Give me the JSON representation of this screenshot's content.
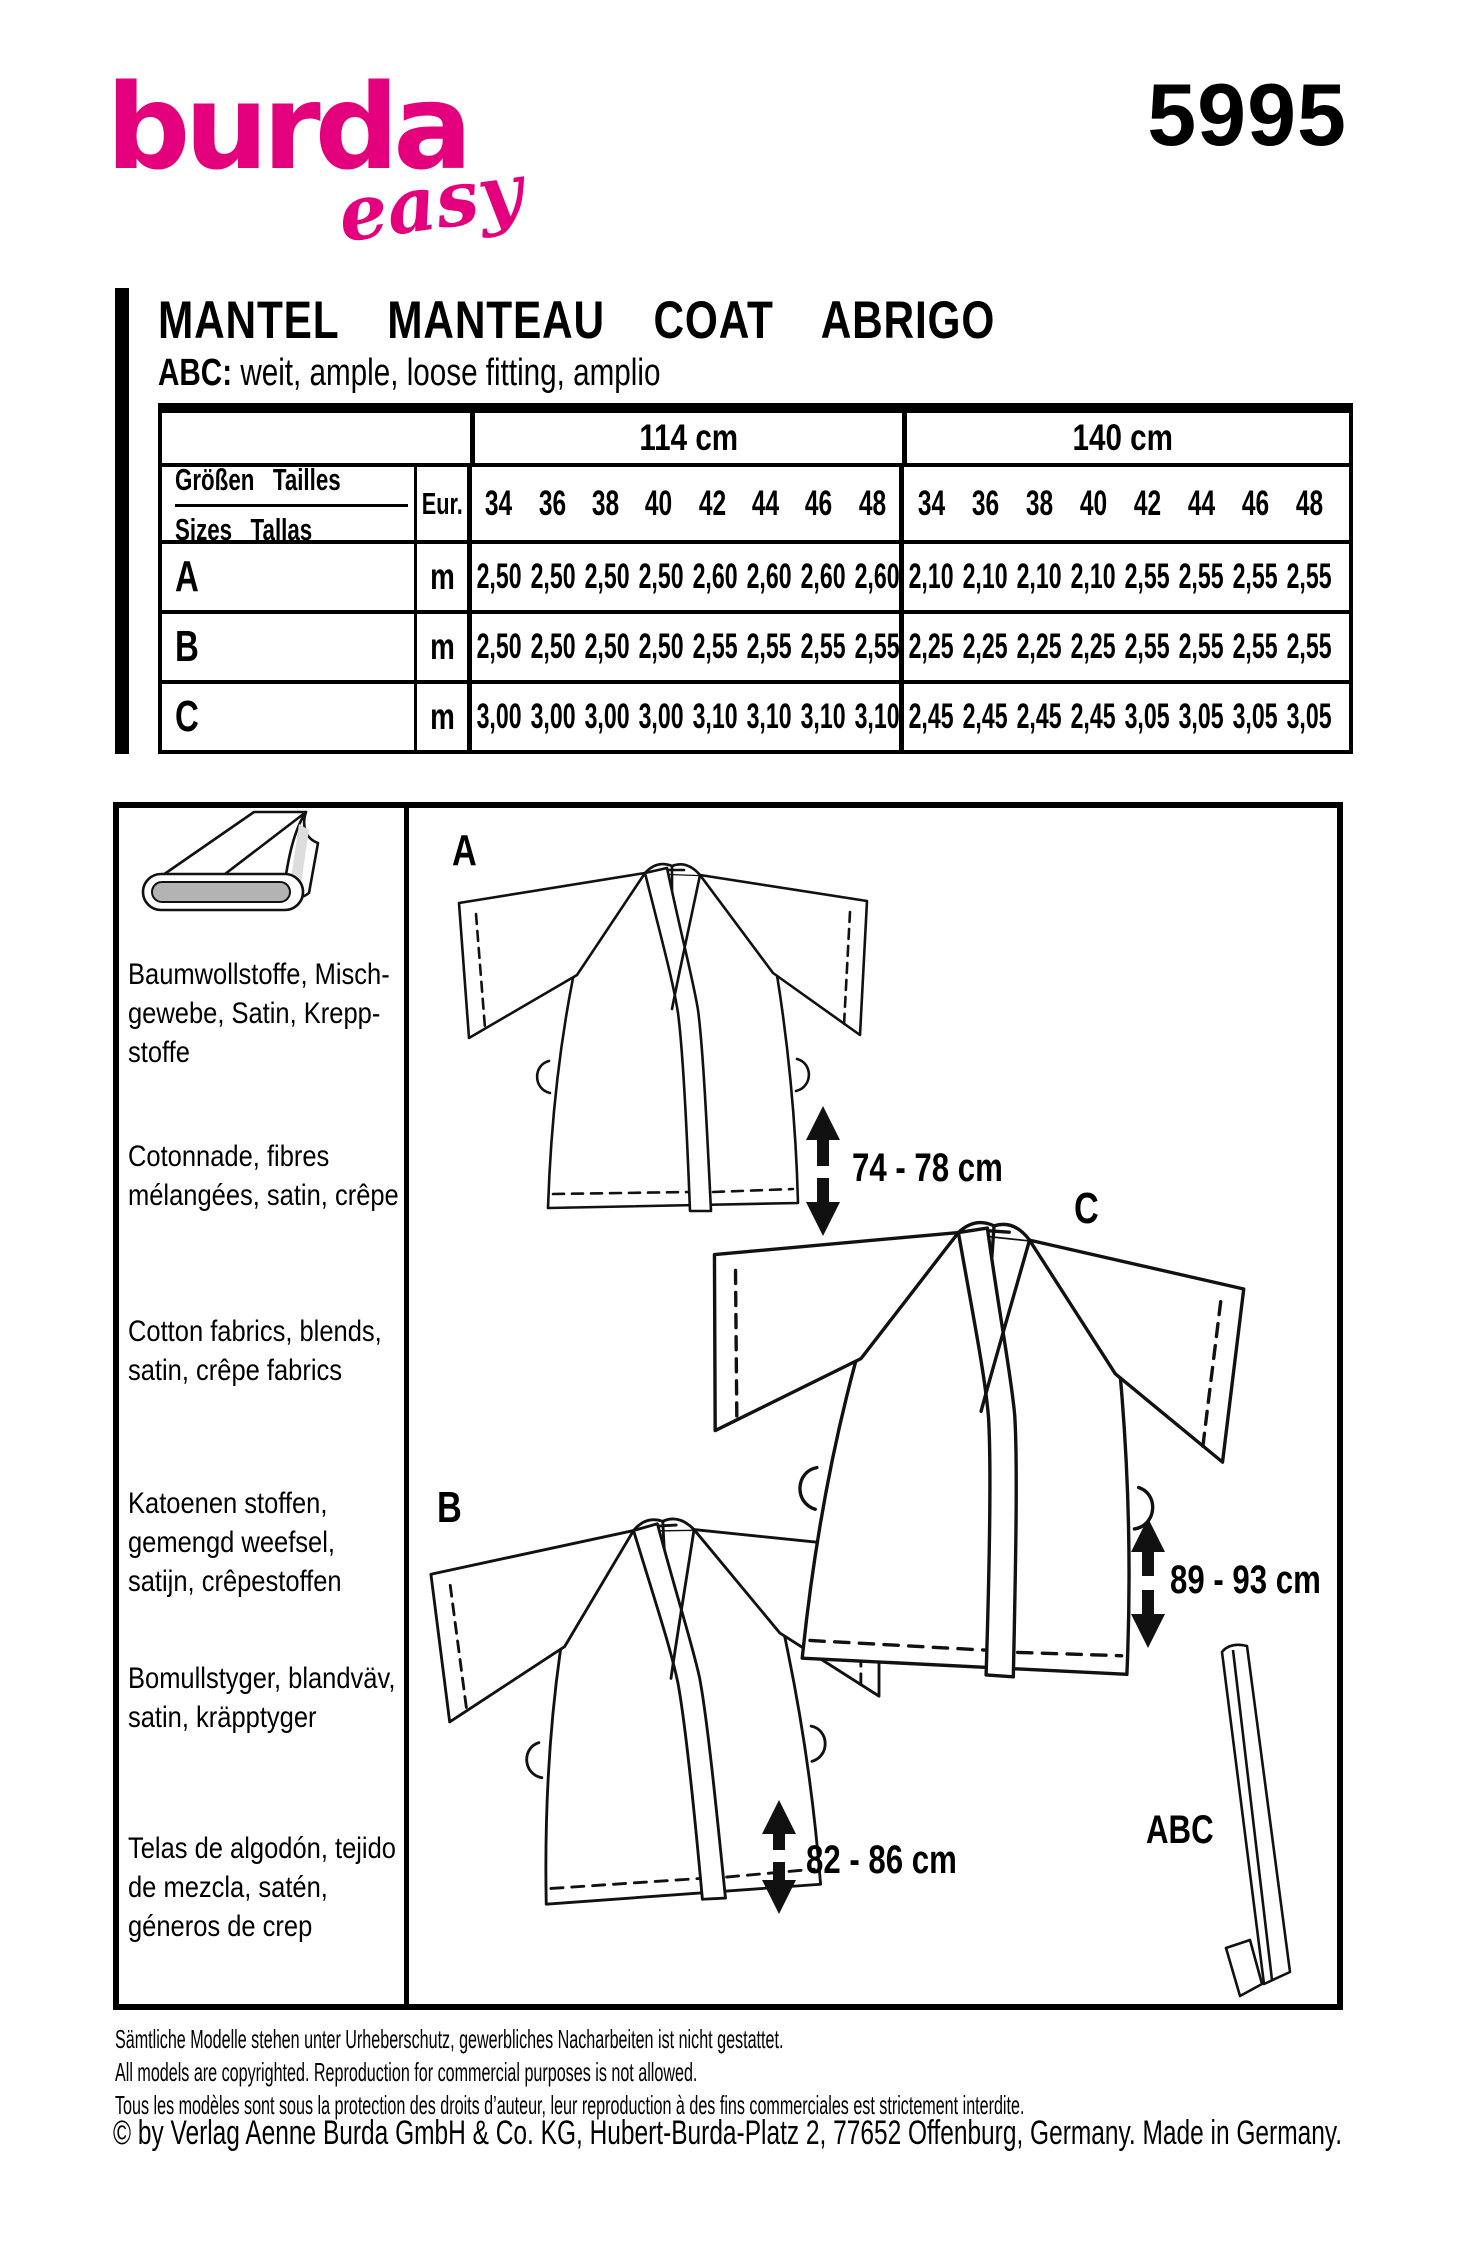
{
  "brand": {
    "logo_main": "burda",
    "logo_sub": "easy",
    "pattern_number": "5995",
    "brand_color": "#e4007c"
  },
  "title": {
    "main": "MANTEL MANTEAU COAT ABRIGO",
    "views_label": "ABC:",
    "views_desc": "weit, ample, loose fitting, amplio"
  },
  "table": {
    "width_groups": [
      "114 cm",
      "140 cm"
    ],
    "row_header_line1": "Größen Tailles",
    "row_header_line2": "Sizes Tallas",
    "eur_label": "Eur.",
    "sizes": [
      "34",
      "36",
      "38",
      "40",
      "42",
      "44",
      "46",
      "48"
    ],
    "rows": [
      {
        "view": "A",
        "unit": "m",
        "values_114": [
          "2,50",
          "2,50",
          "2,50",
          "2,50",
          "2,60",
          "2,60",
          "2,60",
          "2,60"
        ],
        "values_140": [
          "2,10",
          "2,10",
          "2,10",
          "2,10",
          "2,55",
          "2,55",
          "2,55",
          "2,55"
        ]
      },
      {
        "view": "B",
        "unit": "m",
        "values_114": [
          "2,50",
          "2,50",
          "2,50",
          "2,50",
          "2,55",
          "2,55",
          "2,55",
          "2,55"
        ],
        "values_140": [
          "2,25",
          "2,25",
          "2,25",
          "2,25",
          "2,55",
          "2,55",
          "2,55",
          "2,55"
        ]
      },
      {
        "view": "C",
        "unit": "m",
        "values_114": [
          "3,00",
          "3,00",
          "3,00",
          "3,00",
          "3,10",
          "3,10",
          "3,10",
          "3,10"
        ],
        "values_140": [
          "2,45",
          "2,45",
          "2,45",
          "2,45",
          "3,05",
          "3,05",
          "3,05",
          "3,05"
        ]
      }
    ]
  },
  "fabrics": {
    "de": [
      "Baumwollstoffe, Misch-",
      "gewebe, Satin, Krepp-",
      "stoffe"
    ],
    "fr": [
      "Cotonnade, fibres",
      "mélangées, satin, crêpe"
    ],
    "en": [
      "Cotton fabrics, blends,",
      "satin, crêpe fabrics"
    ],
    "nl": [
      "Katoenen stoffen,",
      "gemengd weefsel,",
      "satijn, crêpestoffen"
    ],
    "sv": [
      "Bomullstyger, blandväv,",
      "satin, kräpptyger"
    ],
    "es": [
      "Telas de algodón, tejido",
      "de mezcla, satén,",
      "géneros de crep"
    ]
  },
  "drawings": {
    "label_a": "A",
    "label_b": "B",
    "label_c": "C",
    "label_belt": "ABC",
    "length_a": "74 - 78 cm",
    "length_b": "82 - 86 cm",
    "length_c": "89 - 93 cm"
  },
  "footer": {
    "line_de": "Sämtliche Modelle stehen unter Urheberschutz, gewerbliches Nacharbeiten ist nicht gestattet.",
    "line_en": "All models are copyrighted. Reproduction for commercial purposes is not allowed.",
    "line_fr": "Tous les modèles sont sous la protection des droits d’auteur, leur reproduction à des fins commerciales est strictement interdite.",
    "line_copyright": "© by Verlag Aenne Burda GmbH & Co. KG, Hubert-Burda-Platz 2, 77652 Offenburg, Germany. Made in Germany."
  }
}
